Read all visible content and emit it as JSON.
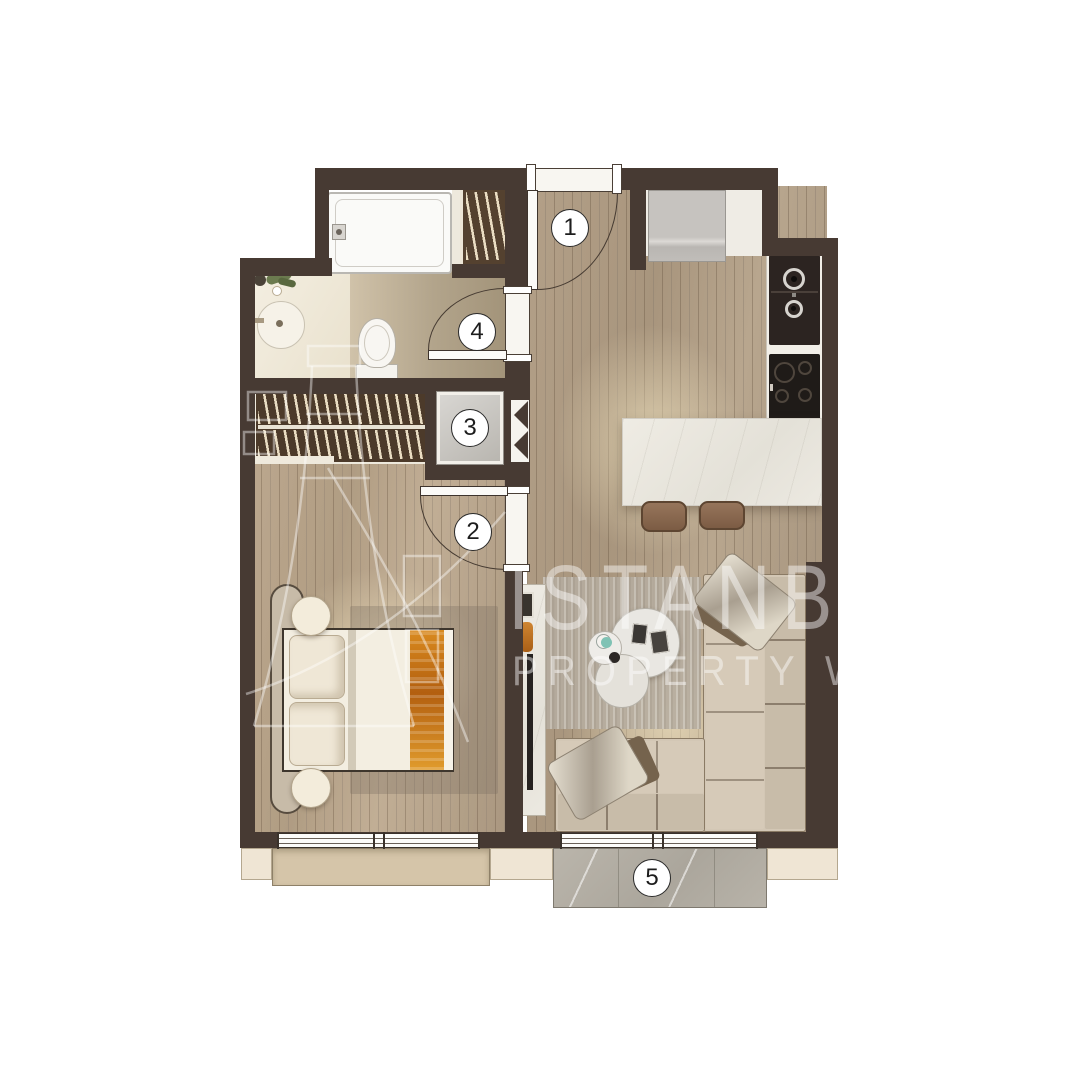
{
  "image_type": "apartment floor plan top-down render",
  "badges": [
    {
      "id": "entrance-door",
      "label": "1"
    },
    {
      "id": "bedroom-door",
      "label": "2"
    },
    {
      "id": "utility-cabinet",
      "label": "3"
    },
    {
      "id": "bathroom-door",
      "label": "4"
    },
    {
      "id": "balcony",
      "label": "5"
    }
  ],
  "watermark": {
    "line1": "ISTANB",
    "line2": "PROPERTY W"
  },
  "palette": {
    "background": "#ffffff",
    "wall": "#473a33",
    "wood_floor": "#ab9880",
    "bath_tile": "#c3b59c",
    "counter_white": "#f2efe8",
    "appliance_dark": "#2c2421",
    "island_marble": "#ebe8e0",
    "sofa_beige": "#d3c7b5",
    "balcony_marble": "#b5b0a6",
    "ledge_beige": "#efe5d4",
    "planter_beige": "#d5c5a9",
    "bed_orange": "#c87c1d",
    "badge_border": "#2a2a2a"
  }
}
